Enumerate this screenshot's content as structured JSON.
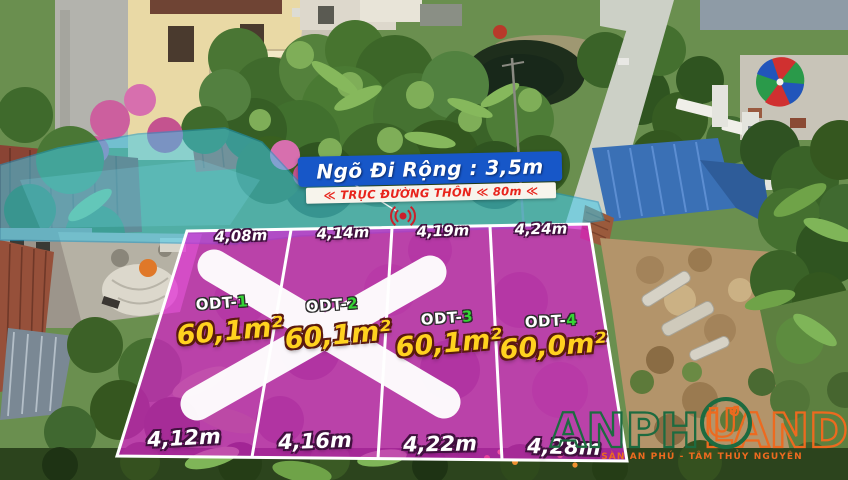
{
  "overlays": {
    "alley_banner": {
      "label": "Ngõ Đi Rộng : 3,5m",
      "bg_color": "#1757c8"
    },
    "road_banner": {
      "label": "≪ TRỤC ĐƯỜNG THÔN ≪ 80m ≪",
      "text_color": "#e8241c"
    }
  },
  "plots": {
    "items": [
      {
        "prefix": "ODT-",
        "number": "1",
        "area": "60,1m²",
        "top_width": "4,08m",
        "bottom_width": "4,12m",
        "status": "sold"
      },
      {
        "prefix": "ODT-",
        "number": "2",
        "area": "60,1m²",
        "top_width": "4,14m",
        "bottom_width": "4,16m",
        "status": "sold"
      },
      {
        "prefix": "ODT-",
        "number": "3",
        "area": "60,1m²",
        "top_width": "4,19m",
        "bottom_width": "4,22m",
        "status": "available"
      },
      {
        "prefix": "ODT-",
        "number": "4",
        "area": "60,0m²",
        "top_width": "4,24m",
        "bottom_width": "4,28m",
        "status": "available"
      }
    ]
  },
  "watermark": {
    "brand_left": "ANPH",
    "brand_mid": "Ư",
    "brand_right": "LAND",
    "tagline": "SÀN AN PHÚ - TÂM THỦY NGUYÊN"
  },
  "colors": {
    "plot_magenta": "#e41ad8",
    "road_cyan": "#3ec9ec",
    "banner_blue": "#1757c8",
    "banner_red": "#e8241c",
    "area_yellow": "#ffd21f",
    "plot_number_green": "#35d435",
    "watermark_green": "#1d6b40",
    "watermark_orange": "#ed6a1f"
  }
}
